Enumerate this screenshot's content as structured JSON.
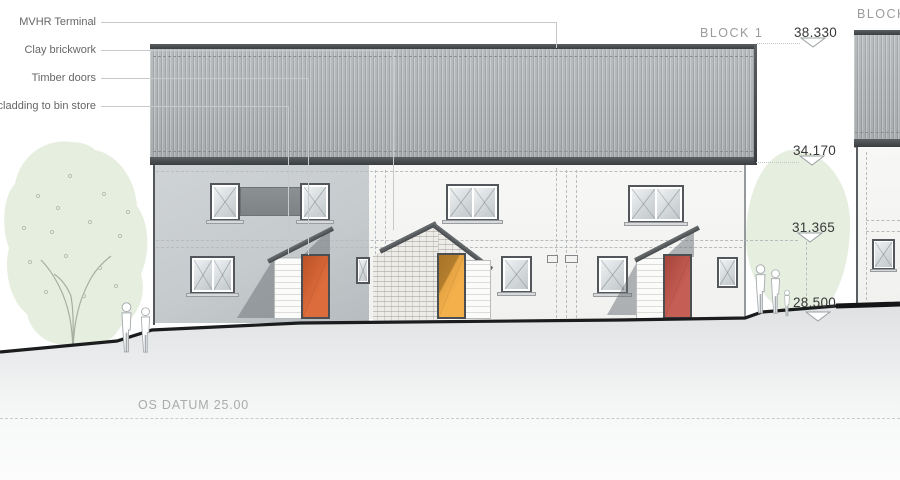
{
  "drawing": {
    "type_label": "street elevation",
    "datum_label": "OS DATUM 25.00"
  },
  "callouts": {
    "items": [
      {
        "label": "MVHR Terminal"
      },
      {
        "label": "Clay brickwork"
      },
      {
        "label": "Timber doors"
      },
      {
        "label": "cladding to bin store"
      }
    ]
  },
  "blocks": {
    "block1_label": "BLOCK 1",
    "block2_label": "BLOCK 2"
  },
  "levels": [
    {
      "value": "38.330"
    },
    {
      "value": "34.170"
    },
    {
      "value": "31.365"
    },
    {
      "value": "28.500"
    }
  ],
  "colors": {
    "door_left": "#d95f2b",
    "door_middle": "#f2a93c",
    "door_right": "#c05045",
    "facade_left": "#c8cccf",
    "facade_white": "#f5f5f3",
    "roof_dark": "#44474a",
    "tree_green": "#e3ecdc",
    "ground_dark": "#1b1c1d",
    "text_dark": "#383838",
    "text_gray": "#9b9b9b"
  }
}
